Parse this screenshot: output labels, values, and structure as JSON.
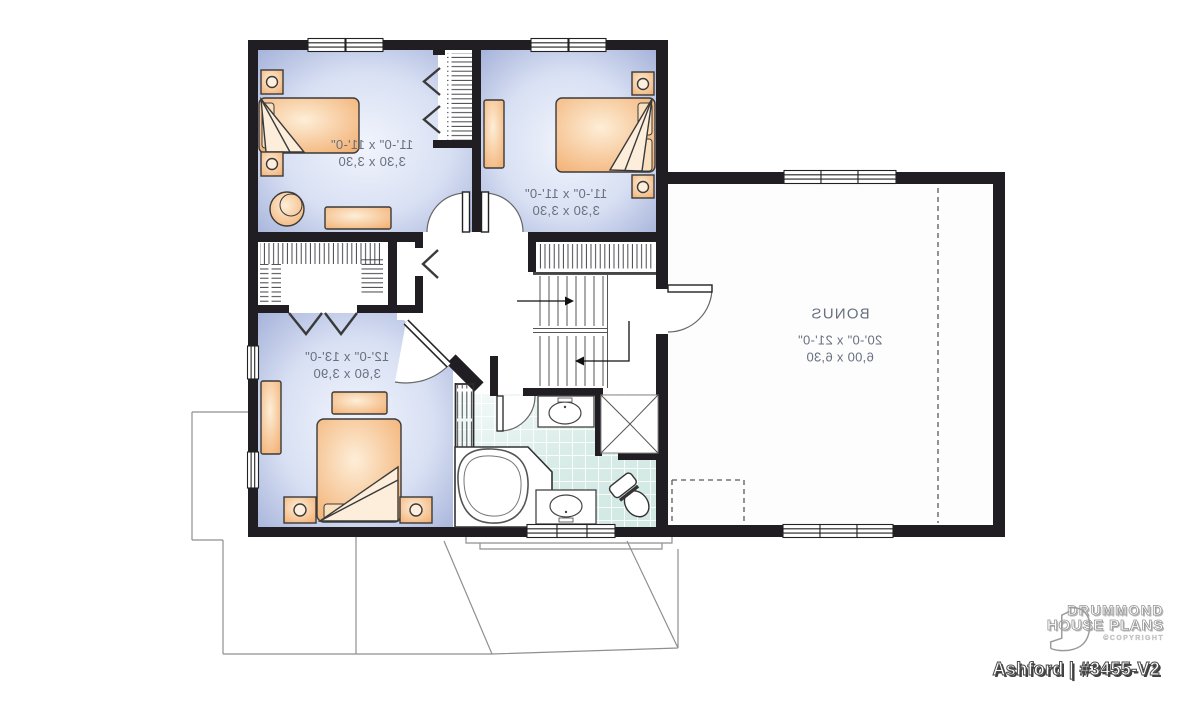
{
  "branding": {
    "brand_line1": "DRUMMOND",
    "brand_line2": "HOUSE PLANS",
    "copyright_label": "©COPYRIGHT",
    "plan_title": "Ashford | #3455-V2"
  },
  "rooms": {
    "bedroom2": {
      "dims_ft": "11'-0\" x 11'-0\"",
      "dims_m": "3,30 x 3,30"
    },
    "bedroom3": {
      "dims_ft": "11'-0\" x 11'-0\"",
      "dims_m": "3,30 x 3,30"
    },
    "master_bedroom": {
      "dims_ft": "12'-0\" x 13'-0\"",
      "dims_m": "3,60 x 3,90"
    },
    "bonus": {
      "name": "BONUS",
      "dims_ft": "20'-0\" x 21'-0\"",
      "dims_m": "6,00 x 6,30"
    }
  },
  "colors": {
    "wall": "#201d23",
    "bedroom_floor_edge": "#a6b3da",
    "bedroom_floor_center": "#f0f3fc",
    "furniture_orange": "#f3b277",
    "tile_teal": "#d2e9e4",
    "label_text": "#68707f"
  },
  "notes": {
    "text_mirrored": "true"
  }
}
